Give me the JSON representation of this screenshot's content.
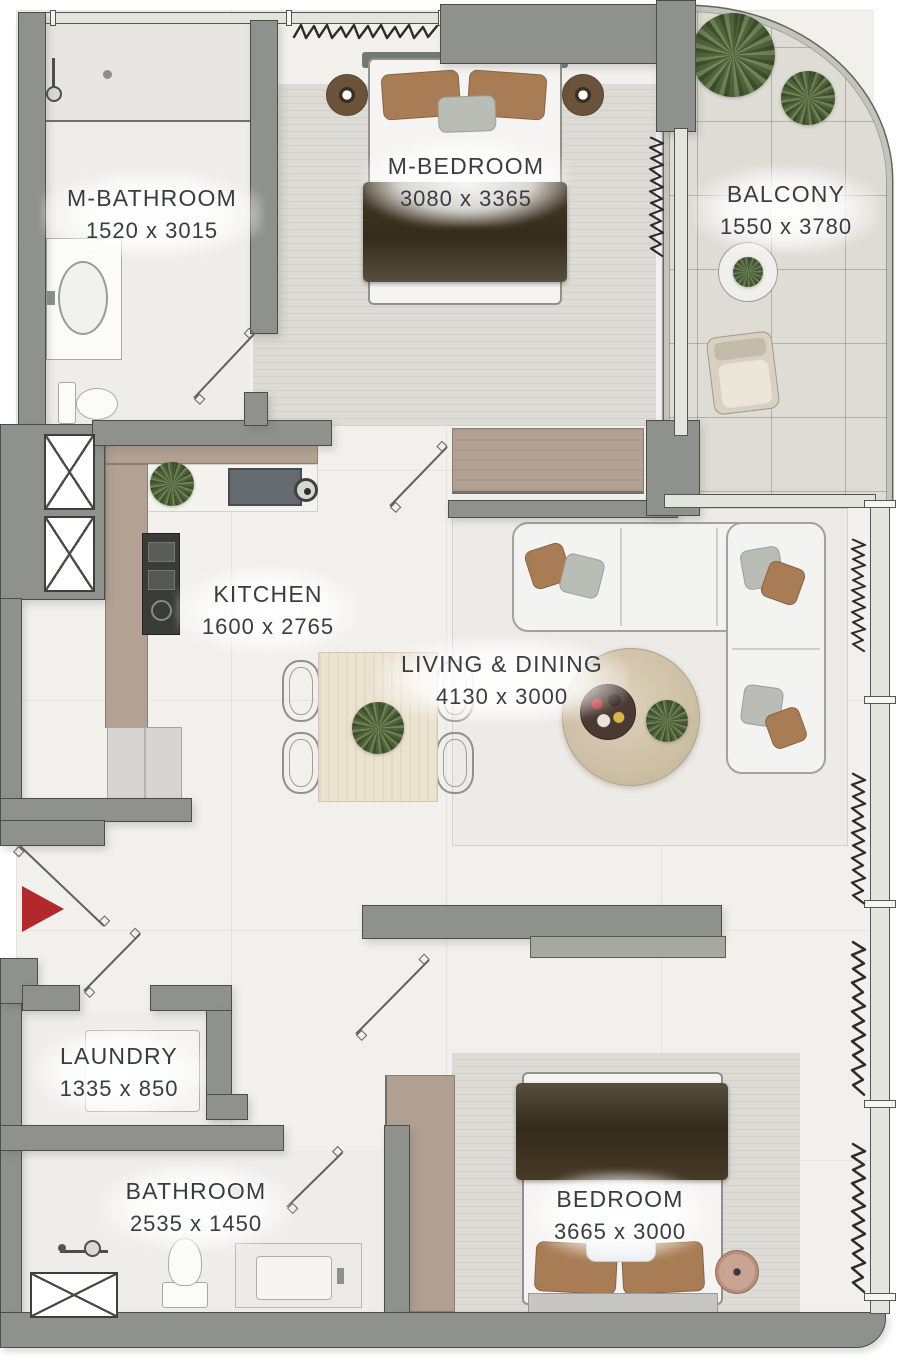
{
  "plan": {
    "type": "apartment-floor-plan",
    "rooms": [
      {
        "id": "m-bathroom",
        "name": "M-BATHROOM",
        "dims": "1520 x 3015"
      },
      {
        "id": "m-bedroom",
        "name": "M-BEDROOM",
        "dims": "3080 x 3365"
      },
      {
        "id": "balcony",
        "name": "BALCONY",
        "dims": "1550 x 3780"
      },
      {
        "id": "kitchen",
        "name": "KITCHEN",
        "dims": "1600 x 2765"
      },
      {
        "id": "living-dining",
        "name": "LIVING & DINING",
        "dims": "4130 x 3000"
      },
      {
        "id": "laundry",
        "name": "LAUNDRY",
        "dims": "1335 x 850"
      },
      {
        "id": "bathroom",
        "name": "BATHROOM",
        "dims": "2535 x 1450"
      },
      {
        "id": "bedroom",
        "name": "BEDROOM",
        "dims": "3665 x 3000"
      }
    ],
    "symbols": [
      "entry-arrow",
      "door-swing",
      "service-shaft",
      "curtain",
      "plant",
      "shower-head"
    ],
    "colors": {
      "wall": "#8f918c",
      "wall_outline": "#4b4d47",
      "floor": "#f1f0ed",
      "balcony_floor": "#dedcd5",
      "carpet": "#dcdbd6",
      "counter_wood": "#b3a293",
      "dining_table": "#ebe3d0",
      "entry_arrow": "#b2282c",
      "blanket": "#342b1a",
      "pillow": "#a87d55",
      "label_text": "#3a3d3f"
    }
  }
}
